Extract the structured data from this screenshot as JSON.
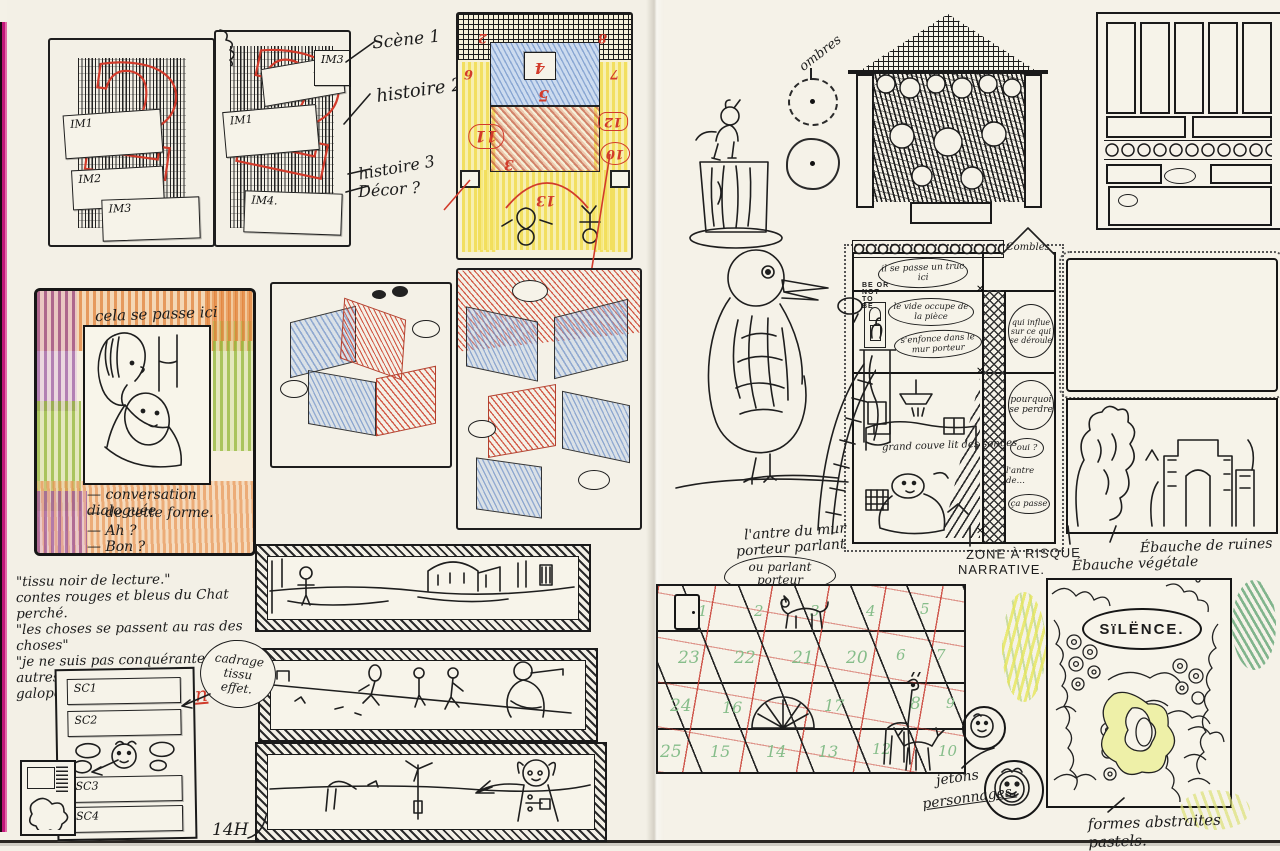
{
  "meta": {
    "artifact": "sketchbook-spread",
    "time_note": "14H"
  },
  "left_page": {
    "labels": {
      "scene1": "Scène 1",
      "histoire2": "histoire 2",
      "histoire3": "histoire 3",
      "decor": "Décor ?"
    },
    "storyboard_a": {
      "cards": [
        "IM1",
        "IM2",
        "IM3"
      ],
      "big_numeral": "2"
    },
    "storyboard_b": {
      "cards": [
        "IM1",
        "IM2",
        "IM3",
        "IM4."
      ],
      "big_numeral": "2"
    },
    "stage": {
      "numbers": {
        "top_left": "2",
        "top_right": "8",
        "upper_left": "6",
        "upper_right": "7",
        "square": "4",
        "mid": "5",
        "center": "3",
        "left_oval": "11",
        "right_tab": "12",
        "right_circle": "10",
        "arc": "13"
      }
    },
    "scene_panel": {
      "caption": "cela se passe ici",
      "lines": [
        "— conversation dialoguée",
        "— de cette forme.",
        "— Ah ?",
        "— Bon ?"
      ]
    },
    "quote": {
      "lines": [
        "\"tissu noir de lecture.\"",
        "contes rouges et bleus du Chat perché.",
        "\"les choses se passent au ras des choses\"",
        "\"je ne suis pas conquérante, les autres",
        "galopent.\""
      ],
      "author": "MH Lafon"
    },
    "sequence_list": {
      "items": [
        "SC1",
        "SC2",
        "SC3",
        "SC4"
      ]
    },
    "cadrage_note": {
      "l1": "cadrage",
      "l2": "tissu",
      "l3": "effet."
    },
    "time": "14H"
  },
  "right_page": {
    "ombres_label": "ombres",
    "house": {
      "hamlet_note": [
        "BE OR",
        "NOT",
        "TO",
        "BE"
      ],
      "attic": "Combles",
      "bubble_top": "il se passe un truc ici",
      "bubble_room": "le vide occupe de la pièce",
      "bubble_wall": "s'enfonce dans le mur porteur",
      "bubble_influence": "qui influe sur ce qui se déroule",
      "bubble_perdre": "pourquoi se perdre",
      "bubble_oui": "oui ?",
      "bubble_ca_passe": "ça passe",
      "antre_note": "l'antre de…",
      "bed_note": "grand couve lit des songes"
    },
    "zone_label": {
      "l1": "ZONE À RISQUE",
      "l2": "NARRATIVE."
    },
    "ebauche_ruines": "Ébauche de ruines",
    "ebauche_vegetale": "Ébauche végétale",
    "wall_note": {
      "l1": "l'antre du mur",
      "l2": "porteur parlant",
      "bubble1": "ou parlant",
      "bubble2": "porteur"
    },
    "calendar": {
      "rows": [
        {
          "c0": "1",
          "c1": "2",
          "c2": "3",
          "c3": "4",
          "c4": "5"
        },
        {
          "c0": "23",
          "c1": "22",
          "c2": "21",
          "c3": "20",
          "c4": "6",
          "c5": "7"
        },
        {
          "c0": "24",
          "c1": "16",
          "c2": "17",
          "c3": "8",
          "c4": "9"
        },
        {
          "c0": "25",
          "c1": "15",
          "c2": "14",
          "c3": "13",
          "c4": "12",
          "c5": "10"
        }
      ]
    },
    "silence_label": "SïLËNCE.",
    "jetons_note": {
      "l1": "jetons",
      "l2": "personnages."
    },
    "pastels_note": "formes abstraites pastels."
  }
}
